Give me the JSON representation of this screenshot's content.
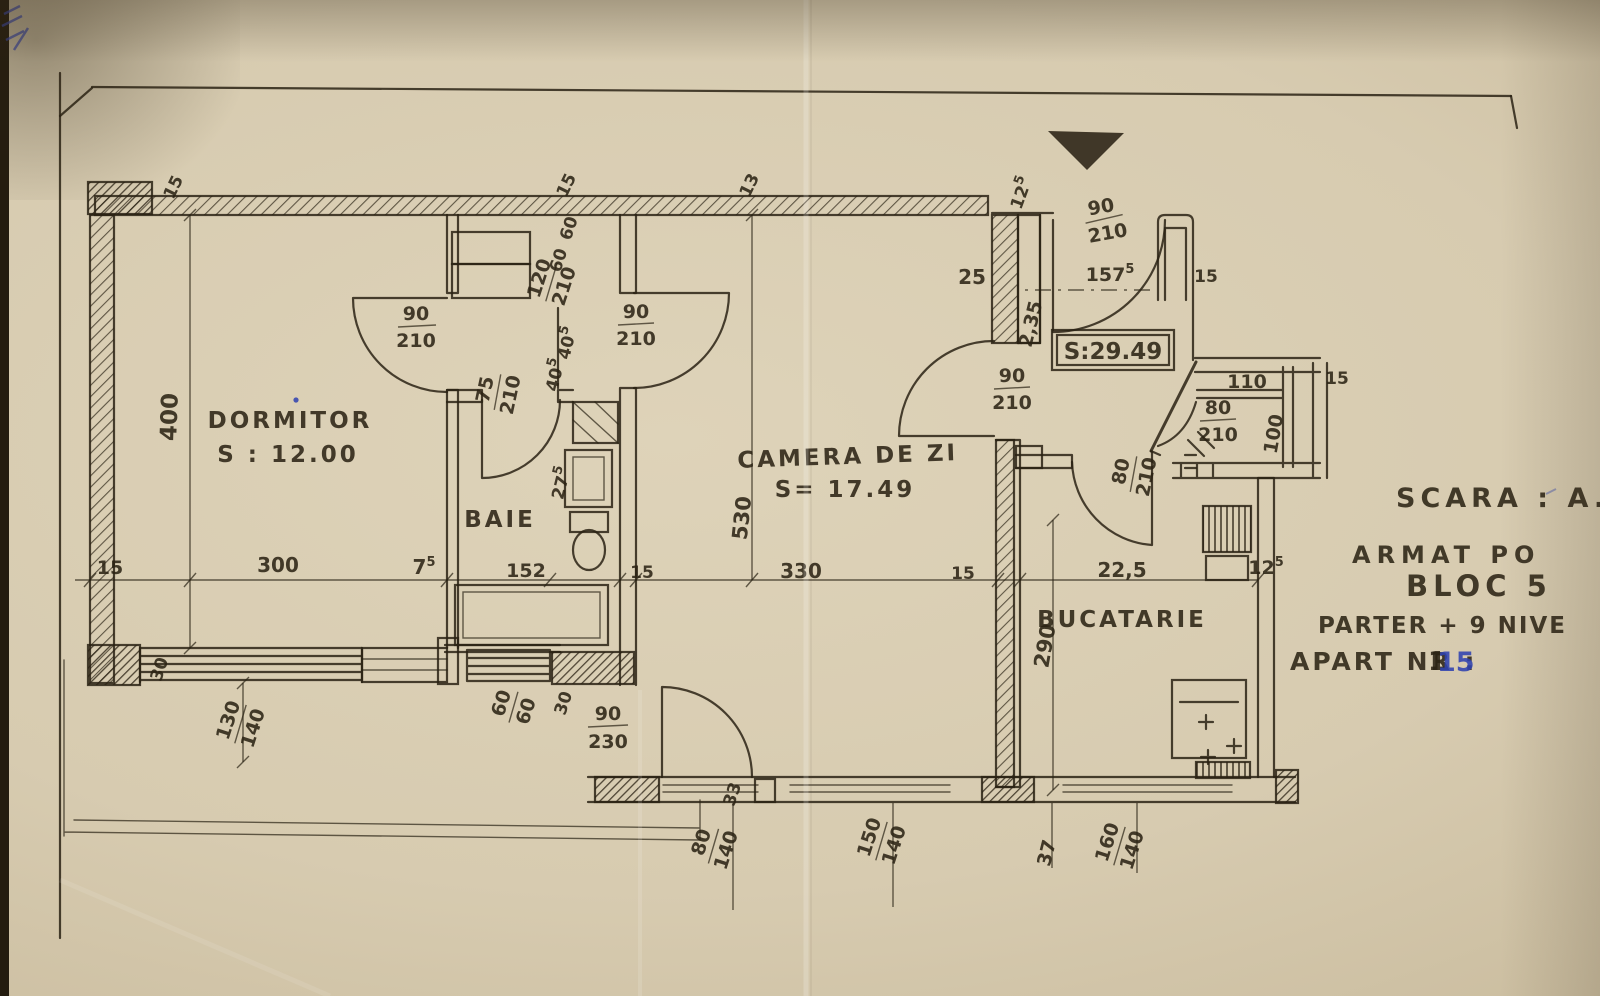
{
  "rooms": {
    "dormitor_name": "DORMITOR",
    "dormitor_area": "S : 12.00",
    "baie_name": "BAIE",
    "camera_name": "CAMERA DE ZI",
    "camera_area": "S= 17.49",
    "bucatarie_name": "BUCATARIE",
    "total_area": "S:29.49"
  },
  "doors": {
    "bedroom_w": "90",
    "bedroom_h": "210",
    "hall_w": "90",
    "hall_h": "210",
    "bath_w": "75",
    "bath_h": "210",
    "vestibule_w": "90",
    "vestibule_h": "210",
    "stair_w": "90",
    "stair_h": "210",
    "entrance_w": "90",
    "entrance_h": "230",
    "kitchen_w": "80",
    "kitchen_h": "210",
    "balcony_w": "80",
    "balcony_h": "210"
  },
  "closet": {
    "w": "120",
    "h": "210",
    "a": "60",
    "b": "60"
  },
  "windows": {
    "bedroom_w": "130",
    "bedroom_h": "140",
    "small_w": "60",
    "small_h": "60",
    "hall_w": "80",
    "hall_h": "140",
    "living_w": "150",
    "living_h": "140",
    "kitchen_w": "160",
    "kitchen_h": "140",
    "balcony": "110"
  },
  "dims": {
    "left15": "15",
    "w300": "300",
    "w75b": "7",
    "w75s": "5",
    "w152": "152",
    "mid15": "15",
    "w330": "330",
    "right15": "15",
    "w225": "22,5",
    "w125b": "12",
    "w125s": "5",
    "v400": "400",
    "v530": "530",
    "v290": "290",
    "v235": "2,35",
    "v100": "100",
    "top15a": "15",
    "top15b": "15",
    "top13": "13",
    "top125b": "12",
    "top125s": "5",
    "e25": "25",
    "e157b": "157",
    "e157s": "5",
    "e15": "15",
    "bal15": "15",
    "s30a": "30",
    "s30b": "30",
    "s33": "33",
    "s37": "37",
    "n40ab": "40",
    "n40as": "5",
    "n40bb": "40",
    "n40bs": "5",
    "n27b": "27",
    "n27s": "5"
  },
  "title": {
    "scara": "SCARA : A.",
    "faded": "ARMAT PO",
    "bloc": "BLOC 5",
    "nivele": "PARTER + 9 NIVE",
    "apart": "APART NR :",
    "no1": "1",
    "no2": "15"
  },
  "colors": {
    "ink": "#2a2214",
    "blue": "#2e41b0",
    "paper": "#d7cbb0"
  }
}
